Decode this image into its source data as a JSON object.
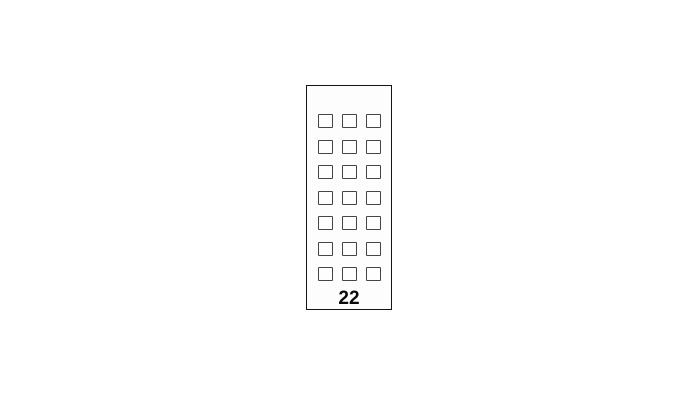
{
  "diagram": {
    "type": "panel-grid",
    "label": "22",
    "grid": {
      "rows": 7,
      "columns": 3,
      "total_cells": 21
    }
  },
  "colors": {
    "background": "#ffffff",
    "panel_border": "#141414",
    "panel_fill": "#fdfdfd",
    "cell_border": "#454545",
    "cell_fill": "#fefefe",
    "label": "#0a0a0a"
  }
}
